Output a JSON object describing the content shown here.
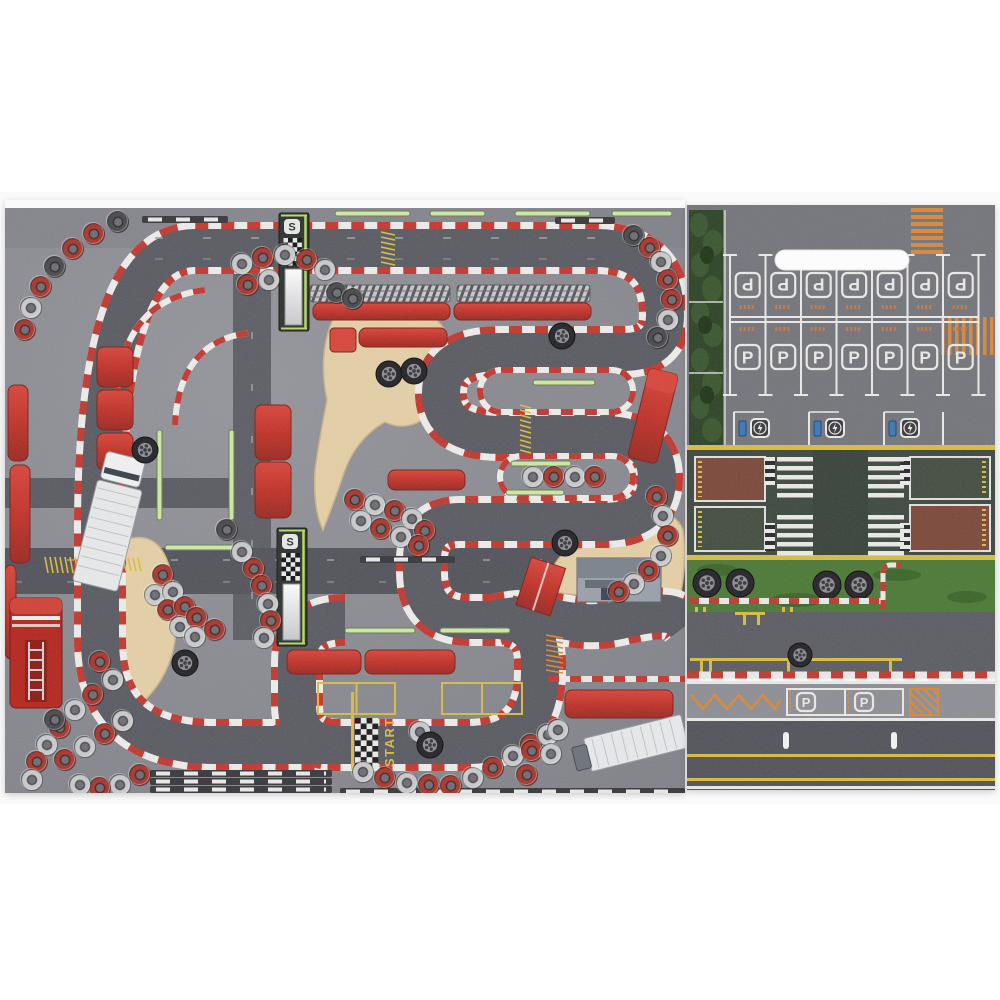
{
  "labels": {
    "start": "START",
    "parking": "P",
    "tower_badge": "S"
  },
  "palette": {
    "backdrop": "#f6f6f7",
    "asphalt_left": "#8a8a91",
    "asphalt_right": "#6e6f75",
    "road_dark": "#54555c",
    "track_gray": "#5b5c63",
    "curb_red": "#c23a31",
    "curb_white": "#edecea",
    "sand": "#e4cfa6",
    "barrier_red": "#c6392f",
    "tire_red": "#a8382f",
    "tire_white": "#c9cacd",
    "tire_dark": "#4b4b4f",
    "green_dash": "#cde8a5",
    "grass": "#4d7a38",
    "hedge": "#2f4527",
    "zone_bg": "#3f4a41",
    "zone_red": "#7b4a3c",
    "zone_green": "#454f41",
    "line_yellow": "#d9bc41",
    "line_orange": "#d9893b",
    "line_white": "#e9e9e7",
    "vehicle_white": "#e8e9ea",
    "fire_red": "#b5281f",
    "building_gray": "#9aa1a9",
    "charger_blue": "#3a79b8"
  },
  "scene": {
    "left": {
      "track_main": "M 250 545 L 210 545 Q 95 545 95 440 L 95 330 Q 95 48 190 48 L 590 48 Q 660 48 660 115 Q 660 152 618 152 L 495 152 Q 436 152 436 193 Q 436 235 495 235 L 598 235 Q 652 235 652 278 Q 652 322 598 322 L 455 322 Q 417 322 417 360 L 417 372 Q 417 420 465 420 L 490 420 Q 535 420 535 462 L 535 472 Q 535 545 462 545 L 250 545",
      "track_branch": "M 340 420 Q 292 420 292 462 L 292 505 Q 292 545 335 545",
      "track_exit": "M 490 420 C 540 406 565 432 615 420 S 672 414 681 426",
      "islands": [
        [
          475,
          170,
          153,
          42
        ],
        [
          495,
          256,
          133,
          42
        ]
      ],
      "deco_curbs": [
        "M 200 90 Q 118 100 112 195",
        "M 243 133 Q 174 142 170 225"
      ],
      "tires": [
        [
          113,
          22,
          "d"
        ],
        [
          89,
          34,
          "r"
        ],
        [
          68,
          49,
          "r"
        ],
        [
          50,
          67,
          "d"
        ],
        [
          36,
          87,
          "r"
        ],
        [
          26,
          108,
          "w"
        ],
        [
          20,
          130,
          "r"
        ],
        [
          237,
          64,
          "w"
        ],
        [
          258,
          58,
          "r"
        ],
        [
          280,
          55,
          "w"
        ],
        [
          302,
          60,
          "r"
        ],
        [
          320,
          70,
          "w"
        ],
        [
          243,
          85,
          "r"
        ],
        [
          264,
          80,
          "w"
        ],
        [
          332,
          93,
          "d"
        ],
        [
          348,
          99,
          "d"
        ],
        [
          629,
          36,
          "d"
        ],
        [
          645,
          48,
          "r"
        ],
        [
          656,
          62,
          "w"
        ],
        [
          663,
          80,
          "r"
        ],
        [
          667,
          100,
          "r"
        ],
        [
          663,
          120,
          "w"
        ],
        [
          653,
          138,
          "d"
        ],
        [
          652,
          297,
          "r"
        ],
        [
          658,
          316,
          "w"
        ],
        [
          663,
          336,
          "r"
        ],
        [
          656,
          356,
          "w"
        ],
        [
          644,
          371,
          "r"
        ],
        [
          629,
          384,
          "w"
        ],
        [
          614,
          392,
          "r"
        ],
        [
          528,
          277,
          "w"
        ],
        [
          549,
          277,
          "r"
        ],
        [
          570,
          277,
          "w"
        ],
        [
          590,
          277,
          "r"
        ],
        [
          350,
          300,
          "r"
        ],
        [
          370,
          305,
          "w"
        ],
        [
          390,
          311,
          "r"
        ],
        [
          407,
          319,
          "w"
        ],
        [
          420,
          331,
          "r"
        ],
        [
          356,
          321,
          "w"
        ],
        [
          376,
          329,
          "r"
        ],
        [
          396,
          337,
          "w"
        ],
        [
          414,
          346,
          "r"
        ],
        [
          158,
          375,
          "r"
        ],
        [
          150,
          395,
          "w"
        ],
        [
          168,
          392,
          "w"
        ],
        [
          163,
          410,
          "r"
        ],
        [
          180,
          407,
          "r"
        ],
        [
          175,
          427,
          "w"
        ],
        [
          192,
          418,
          "r"
        ],
        [
          190,
          437,
          "w"
        ],
        [
          210,
          430,
          "r"
        ],
        [
          222,
          330,
          "d"
        ],
        [
          237,
          352,
          "w"
        ],
        [
          249,
          369,
          "r"
        ],
        [
          257,
          386,
          "r"
        ],
        [
          263,
          404,
          "w"
        ],
        [
          266,
          421,
          "r"
        ],
        [
          259,
          438,
          "w"
        ],
        [
          95,
          462,
          "r"
        ],
        [
          108,
          480,
          "w"
        ],
        [
          88,
          495,
          "r"
        ],
        [
          70,
          510,
          "w"
        ],
        [
          55,
          528,
          "r"
        ],
        [
          42,
          545,
          "w"
        ],
        [
          32,
          562,
          "r"
        ],
        [
          27,
          580,
          "w"
        ],
        [
          60,
          560,
          "r"
        ],
        [
          80,
          547,
          "w"
        ],
        [
          100,
          534,
          "r"
        ],
        [
          118,
          521,
          "w"
        ],
        [
          135,
          575,
          "r"
        ],
        [
          115,
          585,
          "w"
        ],
        [
          95,
          588,
          "r"
        ],
        [
          75,
          585,
          "w"
        ],
        [
          50,
          520,
          "d"
        ],
        [
          415,
          532,
          "w"
        ],
        [
          358,
          572,
          "w"
        ],
        [
          380,
          578,
          "r"
        ],
        [
          402,
          583,
          "w"
        ],
        [
          424,
          585,
          "r"
        ],
        [
          446,
          586,
          "r"
        ],
        [
          468,
          578,
          "w"
        ],
        [
          488,
          568,
          "r"
        ],
        [
          508,
          556,
          "w"
        ],
        [
          526,
          545,
          "r"
        ],
        [
          543,
          535,
          "w"
        ],
        [
          553,
          530,
          "w"
        ],
        [
          527,
          551,
          "r"
        ],
        [
          546,
          554,
          "w"
        ],
        [
          522,
          575,
          "r"
        ]
      ],
      "wheels": [
        [
          384,
          174
        ],
        [
          409,
          171
        ],
        [
          140,
          250
        ],
        [
          425,
          545
        ],
        [
          557,
          136
        ],
        [
          180,
          463
        ],
        [
          560,
          343
        ]
      ],
      "greens": [
        [
          330,
          11,
          75,
          "h"
        ],
        [
          425,
          11,
          55,
          "h"
        ],
        [
          510,
          11,
          75,
          "h"
        ],
        [
          607,
          11,
          60,
          "h"
        ],
        [
          152,
          230,
          90,
          "v"
        ],
        [
          224,
          230,
          90,
          "v"
        ],
        [
          528,
          180,
          62,
          "h"
        ],
        [
          506,
          261,
          60,
          "h"
        ],
        [
          501,
          290,
          58,
          "h"
        ],
        [
          340,
          428,
          70,
          "h"
        ],
        [
          435,
          428,
          70,
          "h"
        ],
        [
          160,
          345,
          70,
          "h"
        ]
      ],
      "rulers": [
        [
          137,
          16,
          86
        ],
        [
          550,
          17,
          60
        ],
        [
          355,
          356,
          95
        ],
        [
          145,
          570,
          182
        ],
        [
          145,
          578,
          182
        ],
        [
          145,
          586,
          182
        ],
        [
          335,
          588,
          345
        ]
      ],
      "ladders_yellow": [
        [
          376,
          32,
          14,
          38
        ],
        [
          40,
          357,
          43,
          16
        ],
        [
          113,
          358,
          28,
          13
        ],
        [
          515,
          205,
          11,
          50
        ]
      ],
      "ladders_orange": [
        [
          541,
          435,
          17,
          40
        ]
      ],
      "chevron_walls": [
        [
          305,
          85,
          140,
          17
        ],
        [
          452,
          85,
          133,
          17
        ]
      ],
      "red_bars": [
        [
          308,
          103,
          137,
          17
        ],
        [
          449,
          103,
          137,
          17
        ],
        [
          354,
          128,
          88,
          19
        ],
        [
          92,
          147,
          36,
          40
        ],
        [
          92,
          190,
          36,
          40
        ],
        [
          92,
          233,
          36,
          37
        ],
        [
          250,
          205,
          36,
          55
        ],
        [
          250,
          262,
          36,
          56
        ],
        [
          383,
          270,
          77,
          20
        ],
        [
          282,
          450,
          74,
          24
        ],
        [
          360,
          450,
          90,
          24
        ],
        [
          560,
          490,
          108,
          28
        ],
        [
          3,
          185,
          20,
          76
        ],
        [
          5,
          265,
          20,
          98
        ],
        [
          0,
          365,
          11,
          94
        ]
      ],
      "red_cab": [
        325,
        128,
        26,
        24
      ],
      "pit_boxes": [
        [
          313,
          483,
          77,
          31
        ],
        [
          437,
          483,
          80,
          31
        ]
      ],
      "towers": [
        [
          274,
          13
        ],
        [
          272,
          328
        ]
      ],
      "start_checker": [
        350,
        518,
        4,
        9
      ],
      "guardrail_br": [
        543,
        479,
        680
      ]
    },
    "right": {
      "stall_xs": [
        60.7,
        96.2,
        131.7,
        167.2,
        202.7,
        238.2,
        273.7
      ],
      "dividers": [
        43,
        78.5,
        114,
        149.5,
        185,
        220.5,
        256,
        291.5
      ],
      "ev_xs": [
        64,
        139,
        214
      ],
      "charger_xs": [
        52,
        127,
        202
      ],
      "grass_wheels": [
        [
          20,
          378
        ],
        [
          53,
          378
        ],
        [
          140,
          380
        ],
        [
          172,
          380
        ]
      ],
      "road_wheel": [
        113,
        450
      ],
      "strip_p_xs": [
        109,
        167
      ]
    }
  }
}
